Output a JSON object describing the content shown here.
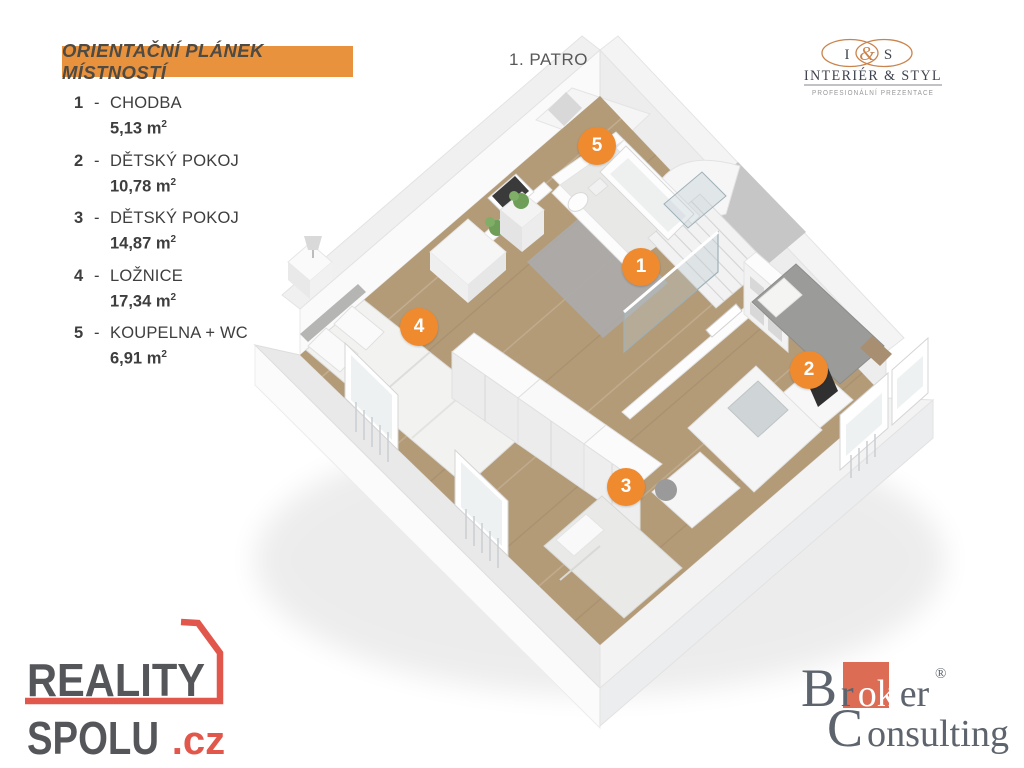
{
  "legend": {
    "title": "ORIENTAČNÍ PLÁNEK MÍSTNOSTÍ",
    "dash": "-",
    "rooms": [
      {
        "number": "1",
        "name": "CHODBA",
        "area": "5,13 m",
        "sup": "2"
      },
      {
        "number": "2",
        "name": "DĚTSKÝ POKOJ",
        "area": "10,78 m",
        "sup": "2"
      },
      {
        "number": "3",
        "name": "DĚTSKÝ POKOJ",
        "area": "14,87 m",
        "sup": "2"
      },
      {
        "number": "4",
        "name": "LOŽNICE",
        "area": "17,34 m",
        "sup": "2"
      },
      {
        "number": "5",
        "name": "KOUPELNA + WC",
        "area": "6,91 m",
        "sup": "2"
      }
    ]
  },
  "floor_label": "1. PATRO",
  "markers": [
    {
      "number": "5",
      "x": 597,
      "y": 146
    },
    {
      "number": "1",
      "x": 641,
      "y": 267
    },
    {
      "number": "4",
      "x": 419,
      "y": 327
    },
    {
      "number": "2",
      "x": 809,
      "y": 370
    },
    {
      "number": "3",
      "x": 626,
      "y": 487
    }
  ],
  "logos": {
    "interier_styl": {
      "left_initial": "I",
      "ampersand": "&",
      "right_initial": "S",
      "name": "INTERIÉR & STYL",
      "tagline": "PROFESIONÁLNÍ PREZENTACE"
    },
    "reality_spolu": {
      "line1": "REALITY",
      "line2": "SPOLU",
      "tld": ".cz"
    },
    "broker_consulting": {
      "b": "B",
      "r": "r",
      "ok": "ok",
      "er": "er",
      "reg": "®",
      "c": "C",
      "onsulting": "onsulting"
    }
  },
  "colors": {
    "accent_orange": "#ef8a2f",
    "banner_orange": "#e8923e",
    "reality_red": "#e2574c",
    "broker_square": "#dd6c55",
    "ins_orange": "#c9834c",
    "wood_floor": "#b49b78"
  }
}
